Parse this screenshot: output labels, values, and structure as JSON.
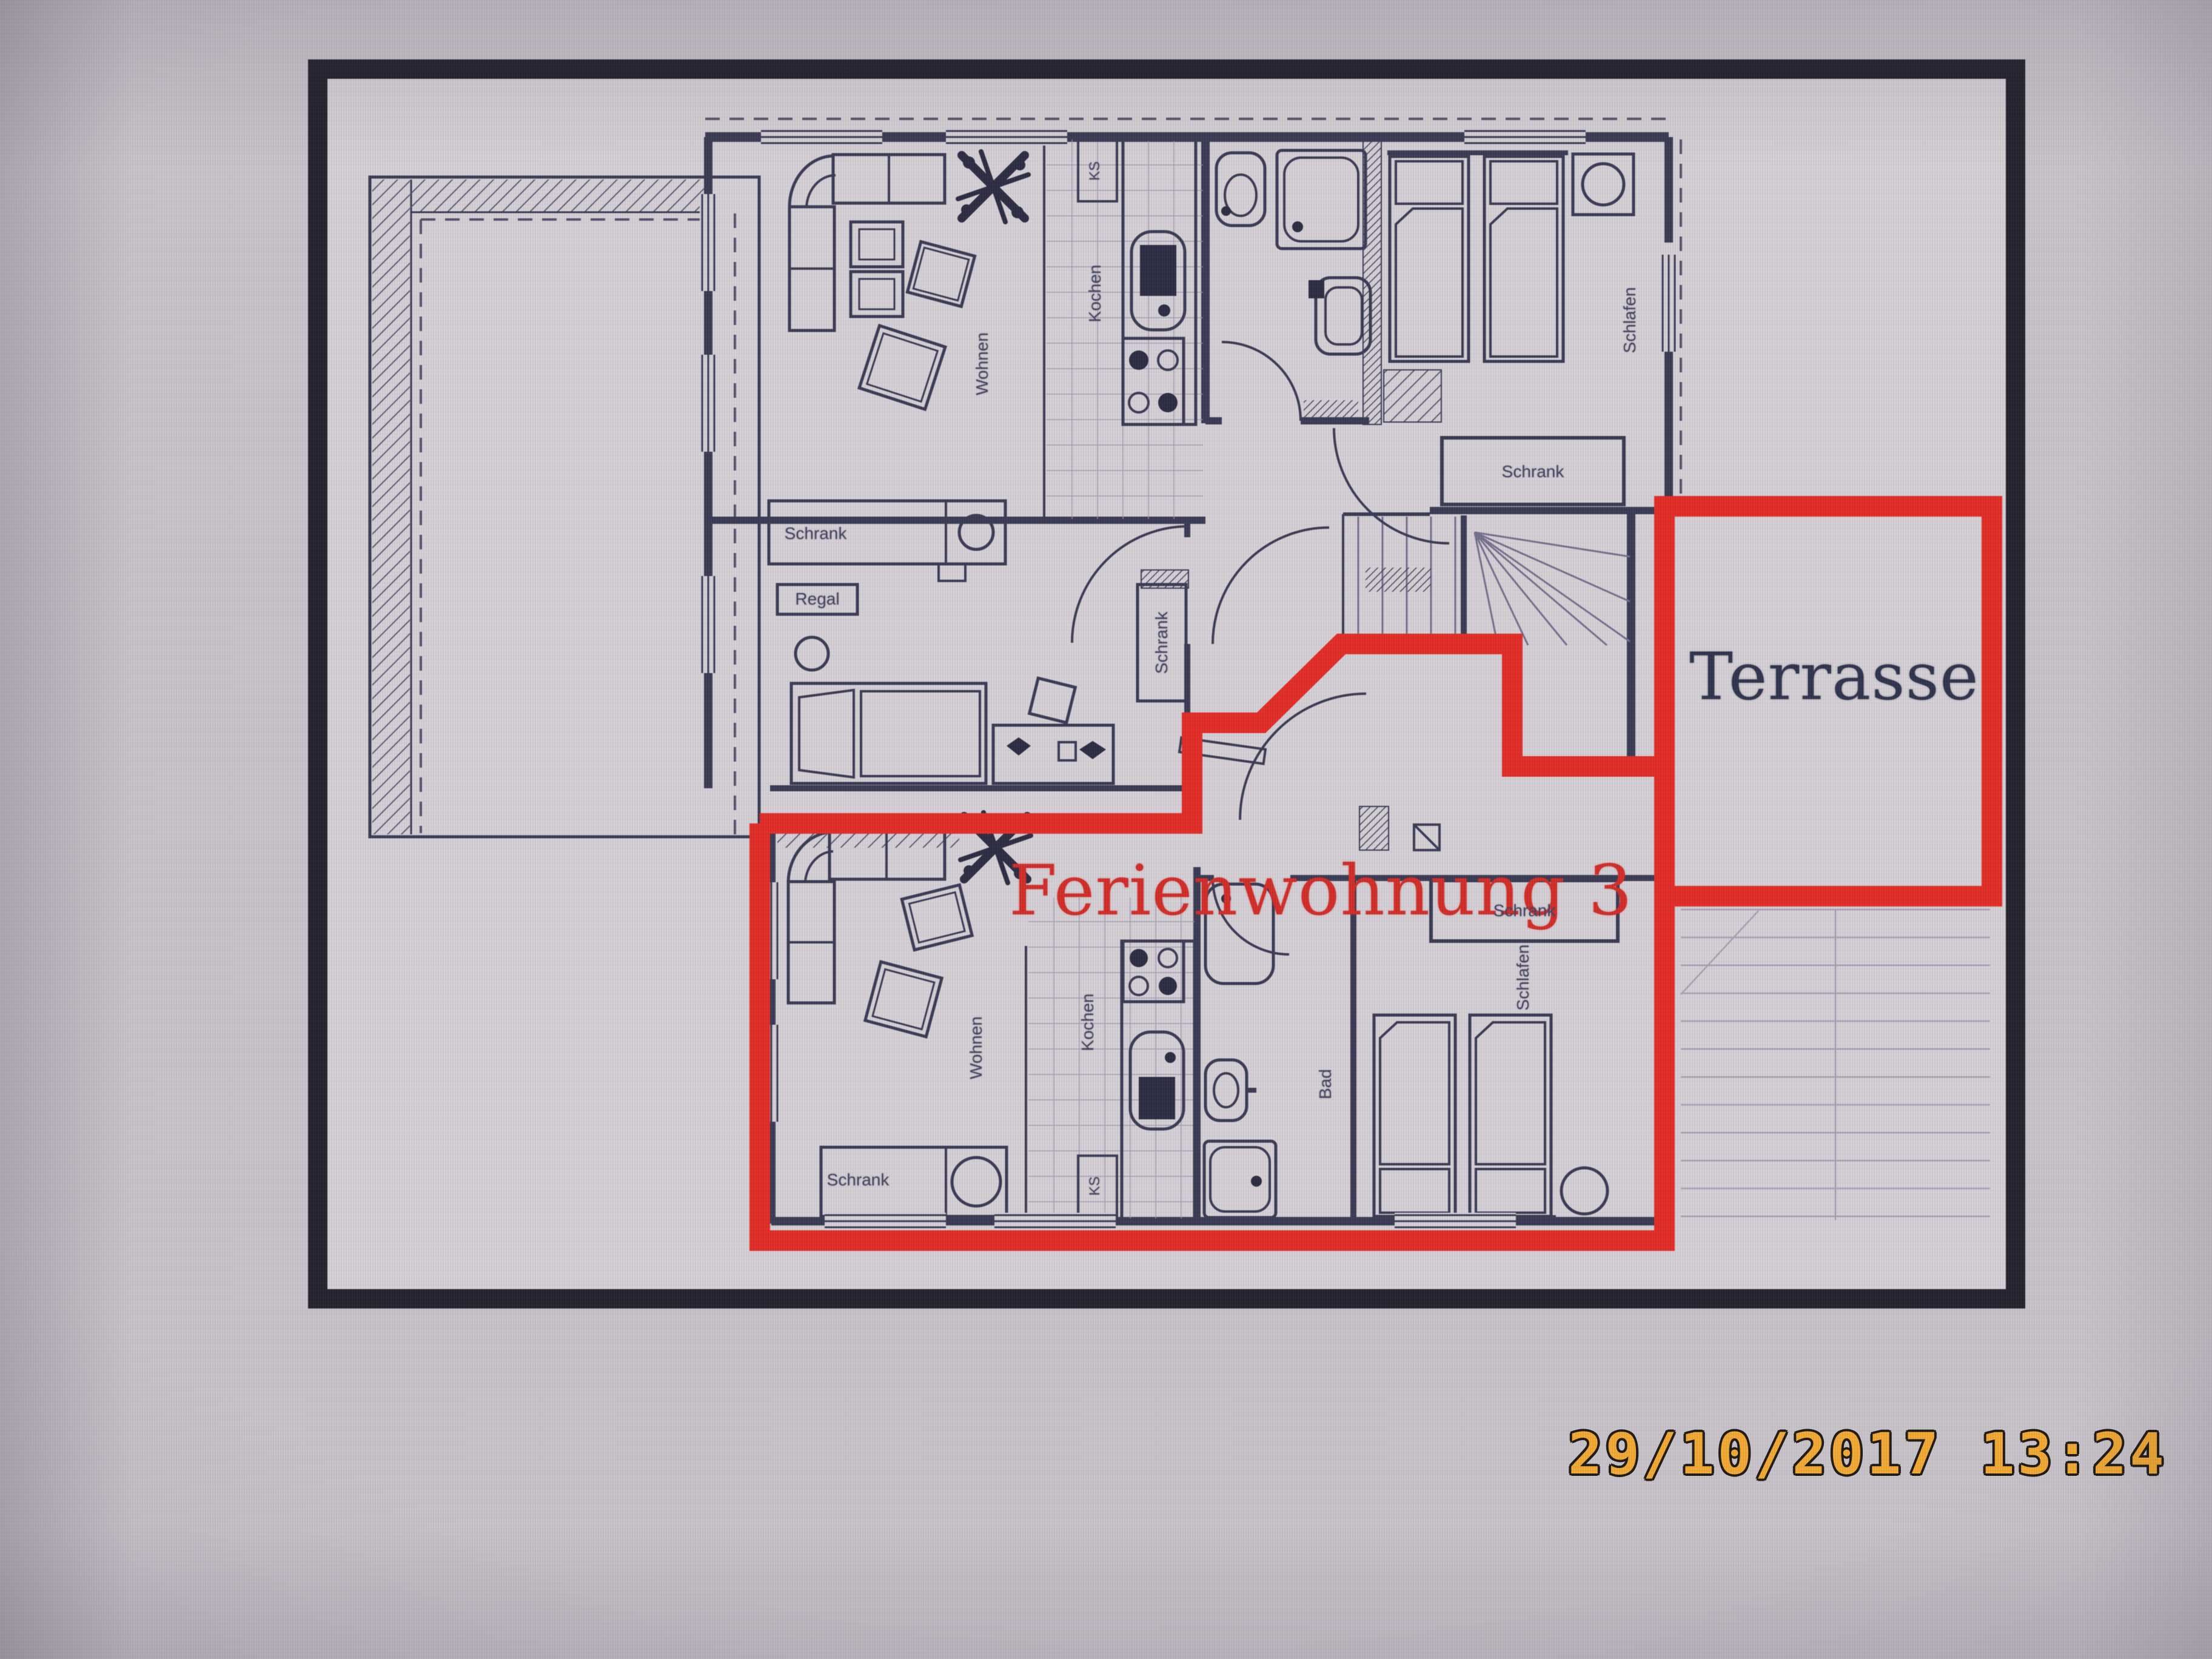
{
  "colors": {
    "bg_outer": "#c7c2c8",
    "plan_paper": "#d4cfd4",
    "frame_color": "#1a1a24",
    "plan_line": "#32324c",
    "boundary_red": "#e2231d",
    "title_red": "#d0241e",
    "terrace_navy": "#262c45",
    "timestamp_orange": "#f2a62a"
  },
  "labels": {
    "apartment_title": "Ferienwohnung 3",
    "terrace": "Terrasse",
    "upper_floor": {
      "living": "Wohnen",
      "kitchen": "Kochen",
      "fridge": "KS",
      "bedroom": "Schlafen",
      "bedroom_wardrobe": "Schrank",
      "small_room_wardrobe": "Schrank",
      "small_room_shelf": "Regal",
      "small_room_tall_wardrobe": "Schrank"
    },
    "apartment3": {
      "living": "Wohnen",
      "kitchen": "Kochen",
      "fridge": "KS",
      "bathroom": "Bad",
      "bedroom": "Schlafen",
      "bedroom_wardrobe": "Schrank",
      "sideboard": "Schrank"
    }
  },
  "timestamp": {
    "date": "29/10/2017",
    "time": "13:24"
  }
}
